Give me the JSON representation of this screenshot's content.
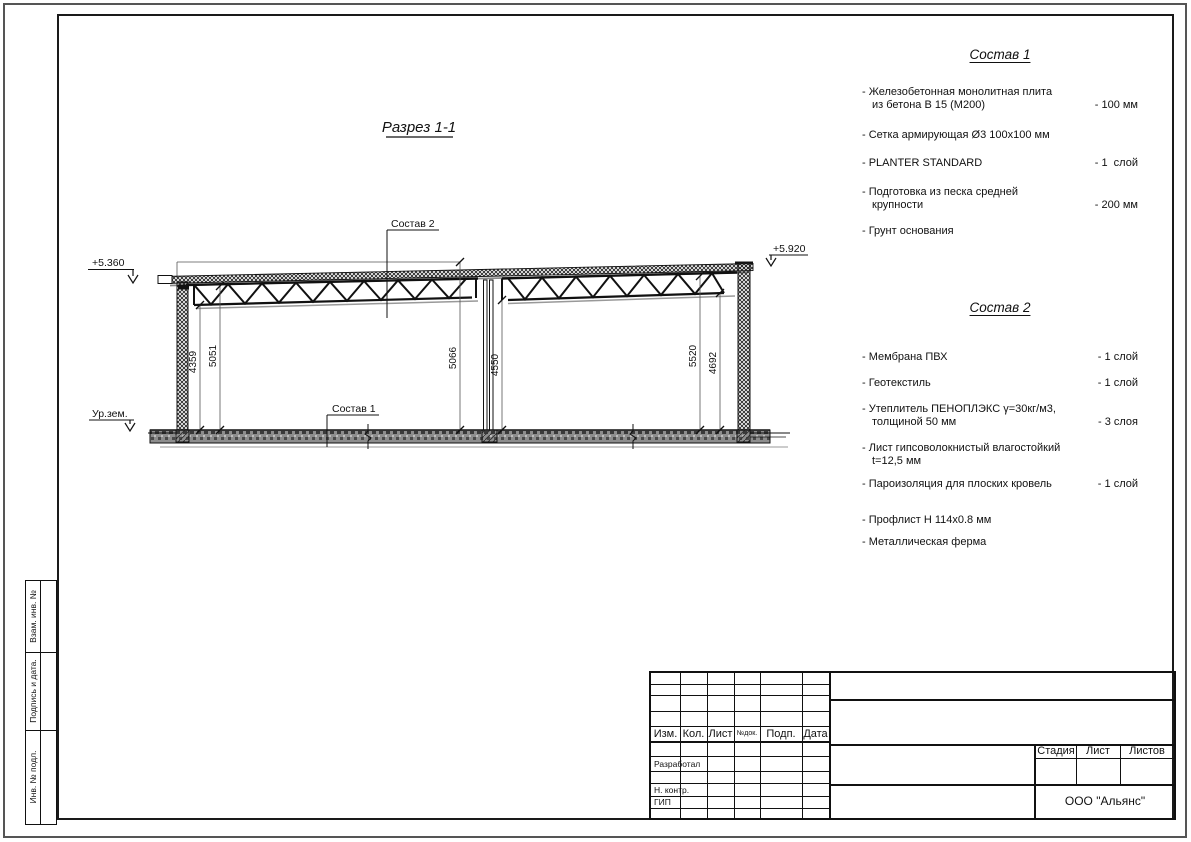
{
  "drawing": {
    "section_title": "Разрез 1-1",
    "elevation_left": "+5.360",
    "elevation_right": "+5.920",
    "ground_level_label": "Ур.зем.",
    "callout_sostav2": "Состав 2",
    "callout_sostav1": "Состав 1",
    "dimensions": [
      "4359",
      "5051",
      "5066",
      "4550",
      "5520",
      "4692"
    ]
  },
  "sostav1": {
    "heading": "Состав 1",
    "items": [
      {
        "text": "- Железобетонная  монолитная плита\nиз бетона В 15 (М200)",
        "value": "- 100 мм"
      },
      {
        "text": "- Сетка армирующая Ø3 100х100 мм",
        "value": ""
      },
      {
        "text": "- PLANTER STANDARD",
        "value": "- 1  слой"
      },
      {
        "text": "- Подготовка из песка средней\nкрупности",
        "value": "- 200 мм"
      },
      {
        "text": "- Грунт основания",
        "value": ""
      }
    ]
  },
  "sostav2": {
    "heading": "Состав 2",
    "items": [
      {
        "text": "- Мембрана ПВХ",
        "value": "- 1 слой"
      },
      {
        "text": "- Геотекстиль",
        "value": "- 1 слой"
      },
      {
        "text": "- Утеплитель ПЕНОПЛЭКС γ=30кг/м3,\nтолщиной 50 мм",
        "value": "- 3 слоя"
      },
      {
        "text": "- Лист гипсоволокнистый влагостойкий\nt=12,5 мм",
        "value": ""
      },
      {
        "text": "- Пароизоляция для плоских кровель",
        "value": "- 1 слой"
      },
      {
        "text": "- Профлист Н 114х0.8 мм",
        "value": ""
      },
      {
        "text": "- Металлическая ферма",
        "value": ""
      }
    ]
  },
  "title_block": {
    "header_columns": [
      "Изм.",
      "Кол.",
      "Лист",
      "№док.",
      "Подп.",
      "Дата"
    ],
    "signature_rows": [
      "Разработал",
      "Н. контр.",
      "ГИП"
    ],
    "stage_headers": [
      "Стадия",
      "Лист",
      "Листов"
    ],
    "company": "ООО \"Альянс\""
  },
  "margin_stamp": {
    "labels": [
      "Взам. инв. №",
      "Подпись и дата.",
      "Инв. № подл."
    ]
  }
}
